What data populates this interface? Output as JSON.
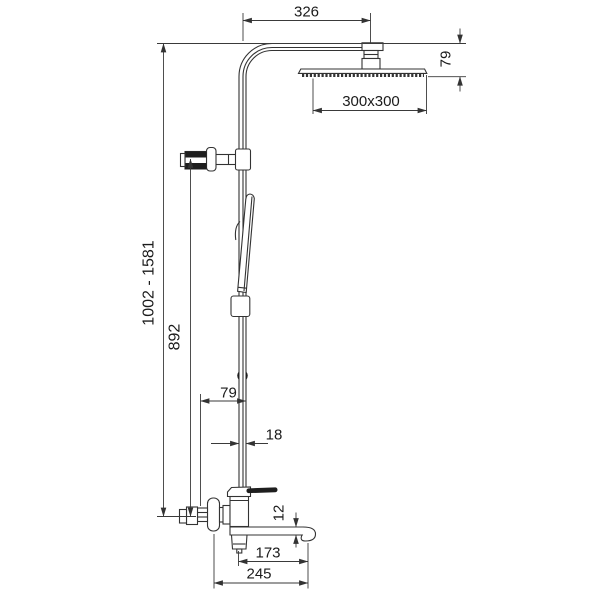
{
  "drawing": {
    "background_color": "#ffffff",
    "line_color": "#333333",
    "labels": {
      "arm_reach": "326",
      "head_drop": "79",
      "head_size": "300x300",
      "height_range": "1002 - 1581",
      "riser_height": "892",
      "riser_offset": "79",
      "pipe_width": "18",
      "spout_thickness": "12",
      "spout_reach": "173",
      "total_reach": "245"
    }
  }
}
